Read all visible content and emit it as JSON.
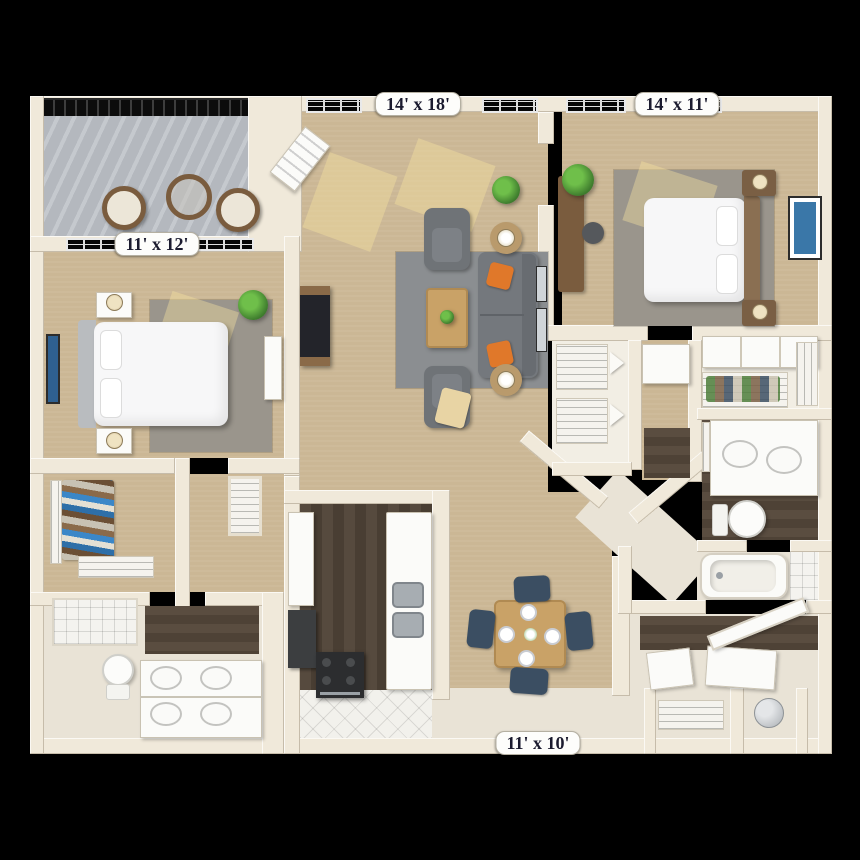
{
  "plan": {
    "type": "3D apartment floor plan, top-down view",
    "rooms": {
      "living_room": {
        "dimensions": "14' x 18'"
      },
      "bedroom_2": {
        "dimensions": "14' x 11'"
      },
      "balcony": {
        "dimensions": "11' x 12'"
      },
      "dining_room": {
        "dimensions": "11' x 10'"
      }
    },
    "colors": {
      "background": "#000000",
      "wall": "#f0e9da",
      "carpet": "#cbb795",
      "area_rug": "#8b8e91",
      "wood_floor": "#4e4237",
      "balcony_concrete": "#b6bac0",
      "sofa_gray": "#74787d",
      "accent_pillow_orange": "#e0782a",
      "dining_chair_navy": "#3b4e62",
      "wood_furniture": "#c9a267",
      "label_text": "#1b1b2f",
      "label_background": "#fdfdfb"
    }
  }
}
